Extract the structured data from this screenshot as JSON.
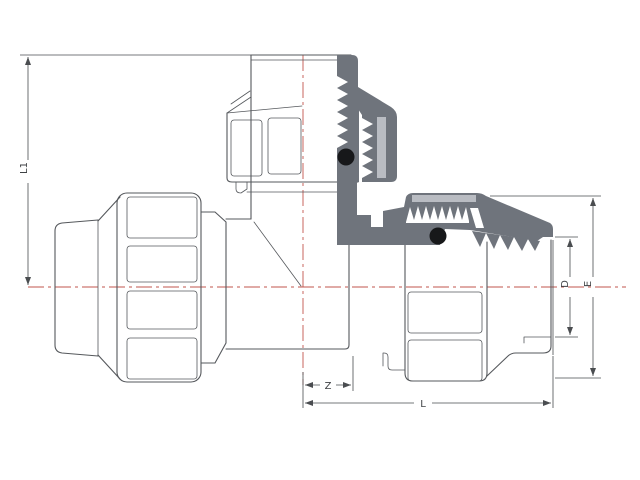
{
  "dimensions": {
    "l1": "L1",
    "z": "Z",
    "l": "L",
    "d": "D",
    "e": "E"
  },
  "colors": {
    "outline": "#55585c",
    "section-fill": "#6f747c",
    "section-highlight": "#b9bcc2",
    "seal-fill": "#17181a",
    "centerline": "#c2564e",
    "dimension-line": "#4a4d50",
    "label-text": "#3f4245",
    "background": "#ffffff"
  }
}
